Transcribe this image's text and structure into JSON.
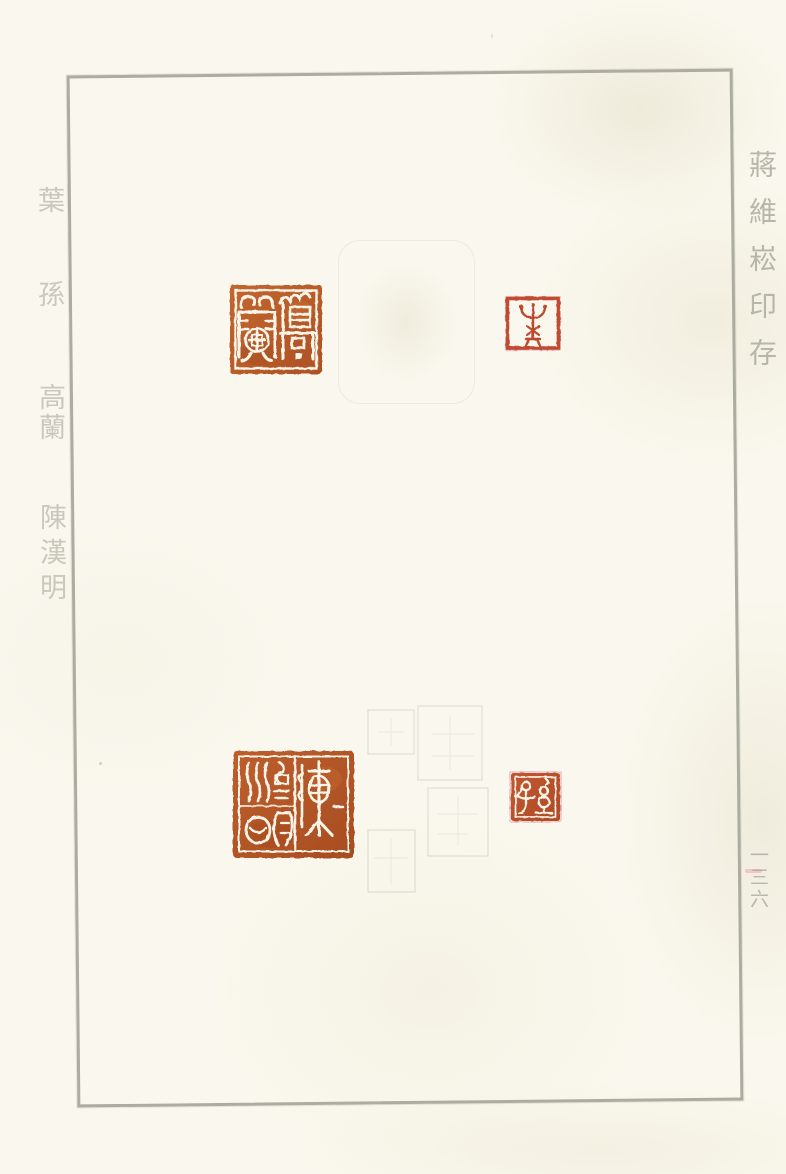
{
  "page": {
    "left_margin_labels": [
      "葉",
      "孫",
      "高蘭",
      "陳漢明"
    ],
    "right_margin_title": "蔣維崧印存",
    "page_number": "一三六"
  },
  "seals": [
    {
      "id": "gaolan",
      "reading": "高蘭",
      "style": "white-on-red intaglio",
      "position": "top-left"
    },
    {
      "id": "ye",
      "reading": "葉",
      "style": "red-outline relief",
      "position": "top-right"
    },
    {
      "id": "chenhanming",
      "reading": "陳漢明",
      "style": "white-on-red intaglio",
      "position": "bottom-left"
    },
    {
      "id": "sun",
      "reading": "孫",
      "style": "white-on-red intaglio",
      "position": "bottom-right"
    }
  ],
  "colors": {
    "paper": "#faf8ee",
    "frame_line": "#adaca1",
    "seal_red": "#b65a2c",
    "seal_red_bright": "#c04c30",
    "margin_text": "#c9c8bd",
    "title_text": "#b7b6ab"
  }
}
